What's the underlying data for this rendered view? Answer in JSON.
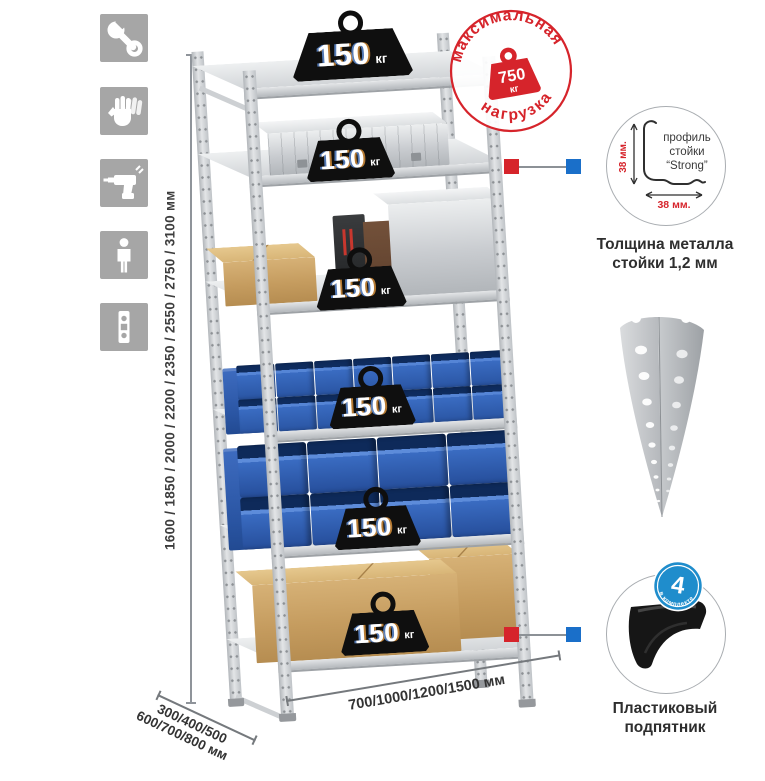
{
  "assembly_icons": {
    "tile_color": "#a6a6a6",
    "items": [
      {
        "name": "wrench-icon"
      },
      {
        "name": "gloves-icon"
      },
      {
        "name": "drill-icon"
      },
      {
        "name": "person-icon"
      },
      {
        "name": "perforated-post-icon"
      }
    ]
  },
  "dimensions": {
    "height_label": "1600 / 1850 / 2000 / 2200 / 2350 / 2550 / 2750 / 3100 мм",
    "depth_label_line1": "300/400/500",
    "depth_label_line2": "600/700/800 мм",
    "width_label": "700/1000/1200/1500 мм"
  },
  "shelf_loads": [
    {
      "value": "150",
      "unit": "кг"
    },
    {
      "value": "150",
      "unit": "кг"
    },
    {
      "value": "150",
      "unit": "кг"
    },
    {
      "value": "150",
      "unit": "кг"
    },
    {
      "value": "150",
      "unit": "кг"
    },
    {
      "value": "150",
      "unit": "кг"
    }
  ],
  "max_load_stamp": {
    "arc_top": "максимальная",
    "arc_bottom": "нагрузка",
    "weight_value": "750",
    "weight_unit": "кг",
    "color": "#d6242b"
  },
  "post_profile": {
    "label_line1": "профиль",
    "label_line2": "стойки",
    "label_line3": "“Strong”",
    "dim_vertical": "38 мм.",
    "dim_horizontal": "38 мм.",
    "caption_line1": "Толщина металла",
    "caption_line2": "стойки 1,2 мм"
  },
  "plastic_foot": {
    "badge_number": "4",
    "badge_text": "в комплекте",
    "caption_line1": "Пластиковый",
    "caption_line2": "подпятник"
  },
  "callout_colors": {
    "red": "#d6242b",
    "blue": "#1a6fc9"
  }
}
